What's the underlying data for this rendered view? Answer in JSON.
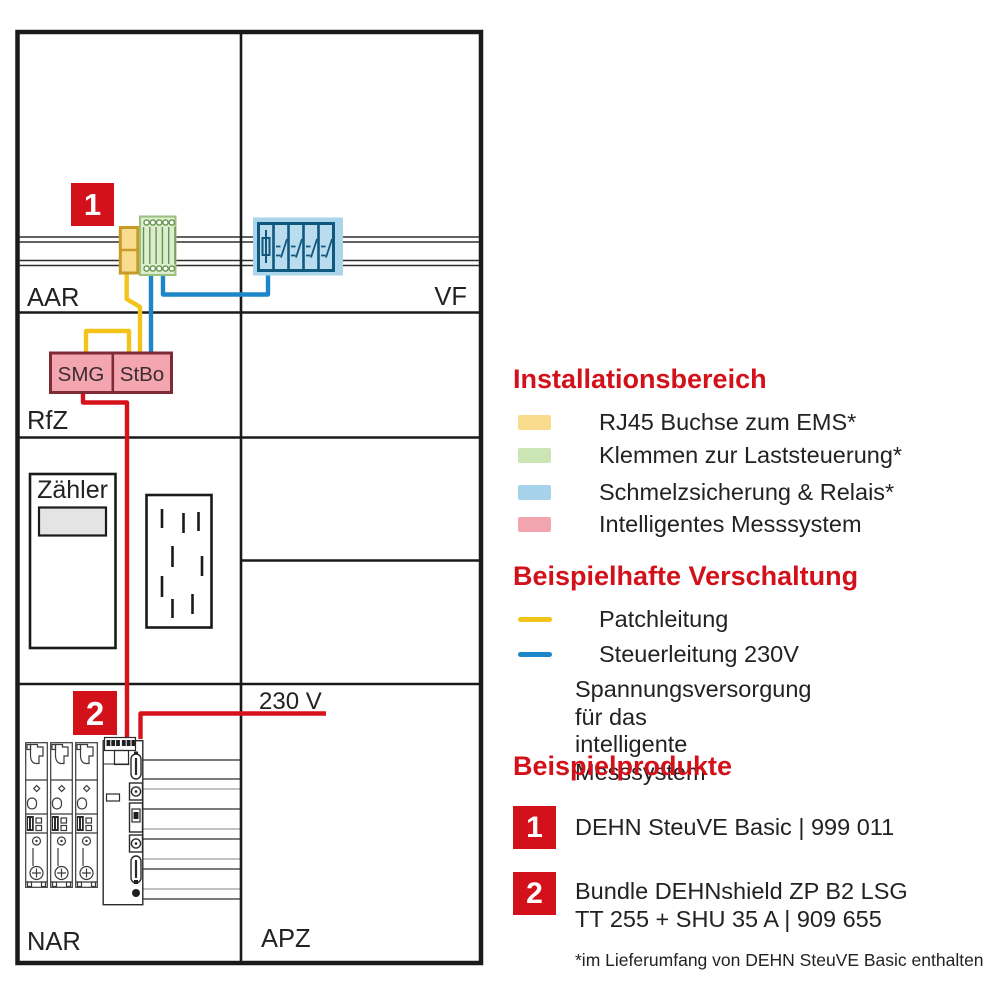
{
  "colors": {
    "accent_red": "#D2111A",
    "text": "#222222",
    "rj45_yellow": "#F8DB8D",
    "terminal_green": "#CBE5B5",
    "fuse_blue": "#A6D2EA",
    "meter_pink": "#F3A5AF",
    "wire_yellow": "#F2C318",
    "wire_blue": "#1C86C8",
    "wire_red": "#D6121B"
  },
  "panel": {
    "area_labels": {
      "top_left": "AAR",
      "top_right": "VF",
      "mid_left": "RfZ",
      "bottom_left": "NAR",
      "bottom_right": "APZ"
    },
    "components": {
      "meter": "Zähler",
      "smg": "SMG",
      "stbo": "StBo"
    },
    "voltage_label": "230 V",
    "marker_1": "1",
    "marker_2": "2"
  },
  "legend": {
    "areas": {
      "title": "Installationsbereich",
      "items": [
        {
          "label": "RJ45 Buchse zum EMS*",
          "color": "#F8DB8D"
        },
        {
          "label": "Klemmen zur Laststeuerung*",
          "color": "#CBE5B5"
        },
        {
          "label": "Schmelzsicherung & Relais*",
          "color": "#A6D2EA"
        },
        {
          "label": "Intelligentes Messsystem",
          "color": "#F3A5AF"
        }
      ]
    },
    "wiring": {
      "title": "Beispielhafte Verschaltung",
      "items": [
        {
          "lines": [
            "Patchleitung"
          ],
          "color": "#F2C318"
        },
        {
          "lines": [
            "Steuerleitung 230V"
          ],
          "color": "#1C86C8"
        },
        {
          "lines": [
            "Spannungsversorgung für das",
            "intelligente Messsystem"
          ],
          "color": "#D6121B"
        }
      ]
    },
    "products": {
      "title": "Beispielprodukte",
      "items": [
        {
          "badge": "1",
          "lines": [
            "DEHN SteuVE Basic | 999 011"
          ]
        },
        {
          "badge": "2",
          "lines": [
            "Bundle DEHNshield ZP B2 LSG",
            "TT 255 + SHU 35 A | 909 655"
          ]
        }
      ]
    },
    "footnote": "*im Lieferumfang von DEHN SteuVE Basic enthalten"
  }
}
